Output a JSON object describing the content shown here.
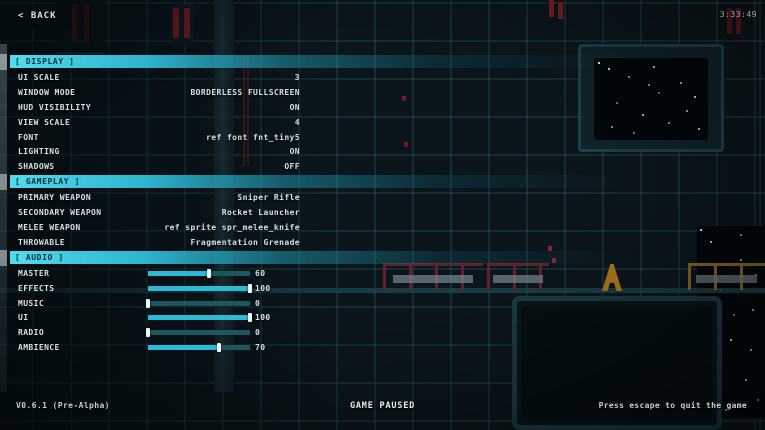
{
  "window": {
    "back_label": "< BACK",
    "session_time": "3:33:49"
  },
  "menu": {
    "sections": [
      {
        "title": "[ DISPLAY ]",
        "rows": [
          {
            "label": "UI SCALE",
            "value": "3"
          },
          {
            "label": "WINDOW MODE",
            "value": "BORDERLESS FULLSCREEN"
          },
          {
            "label": "HUD VISIBILITY",
            "value": "ON"
          },
          {
            "label": "VIEW SCALE",
            "value": "4"
          },
          {
            "label": "FONT",
            "value": "ref font fnt_tiny5"
          },
          {
            "label": "LIGHTING",
            "value": "ON"
          },
          {
            "label": "SHADOWS",
            "value": "OFF"
          }
        ]
      },
      {
        "title": "[ GAMEPLAY ]",
        "rows": [
          {
            "label": "PRIMARY WEAPON",
            "value": "Sniper Rifle"
          },
          {
            "label": "SECONDARY WEAPON",
            "value": "Rocket Launcher"
          },
          {
            "label": "MELEE WEAPON",
            "value": "ref sprite spr_melee_knife"
          },
          {
            "label": "THROWABLE",
            "value": "Fragmentation Grenade"
          }
        ]
      },
      {
        "title": "[ AUDIO ]",
        "rows": [
          {
            "label": "MASTER",
            "value": "60",
            "slider_percent": 60
          },
          {
            "label": "EFFECTS",
            "value": "100",
            "slider_percent": 100
          },
          {
            "label": "MUSIC",
            "value": "0",
            "slider_percent": 0
          },
          {
            "label": "UI",
            "value": "100",
            "slider_percent": 100
          },
          {
            "label": "RADIO",
            "value": "0",
            "slider_percent": 0
          },
          {
            "label": "AMBIENCE",
            "value": "70",
            "slider_percent": 70
          }
        ]
      }
    ]
  },
  "footer": {
    "version": "V0.6.1 (Pre-Alpha)",
    "status": "GAME PAUSED",
    "hint": "Press escape to quit the game"
  },
  "colors": {
    "accent": "#2fc2dd",
    "slider_fill": "#2cb9d6",
    "slider_track": "#1d565c",
    "header_text": "#05313b",
    "background": "#0b161c"
  }
}
